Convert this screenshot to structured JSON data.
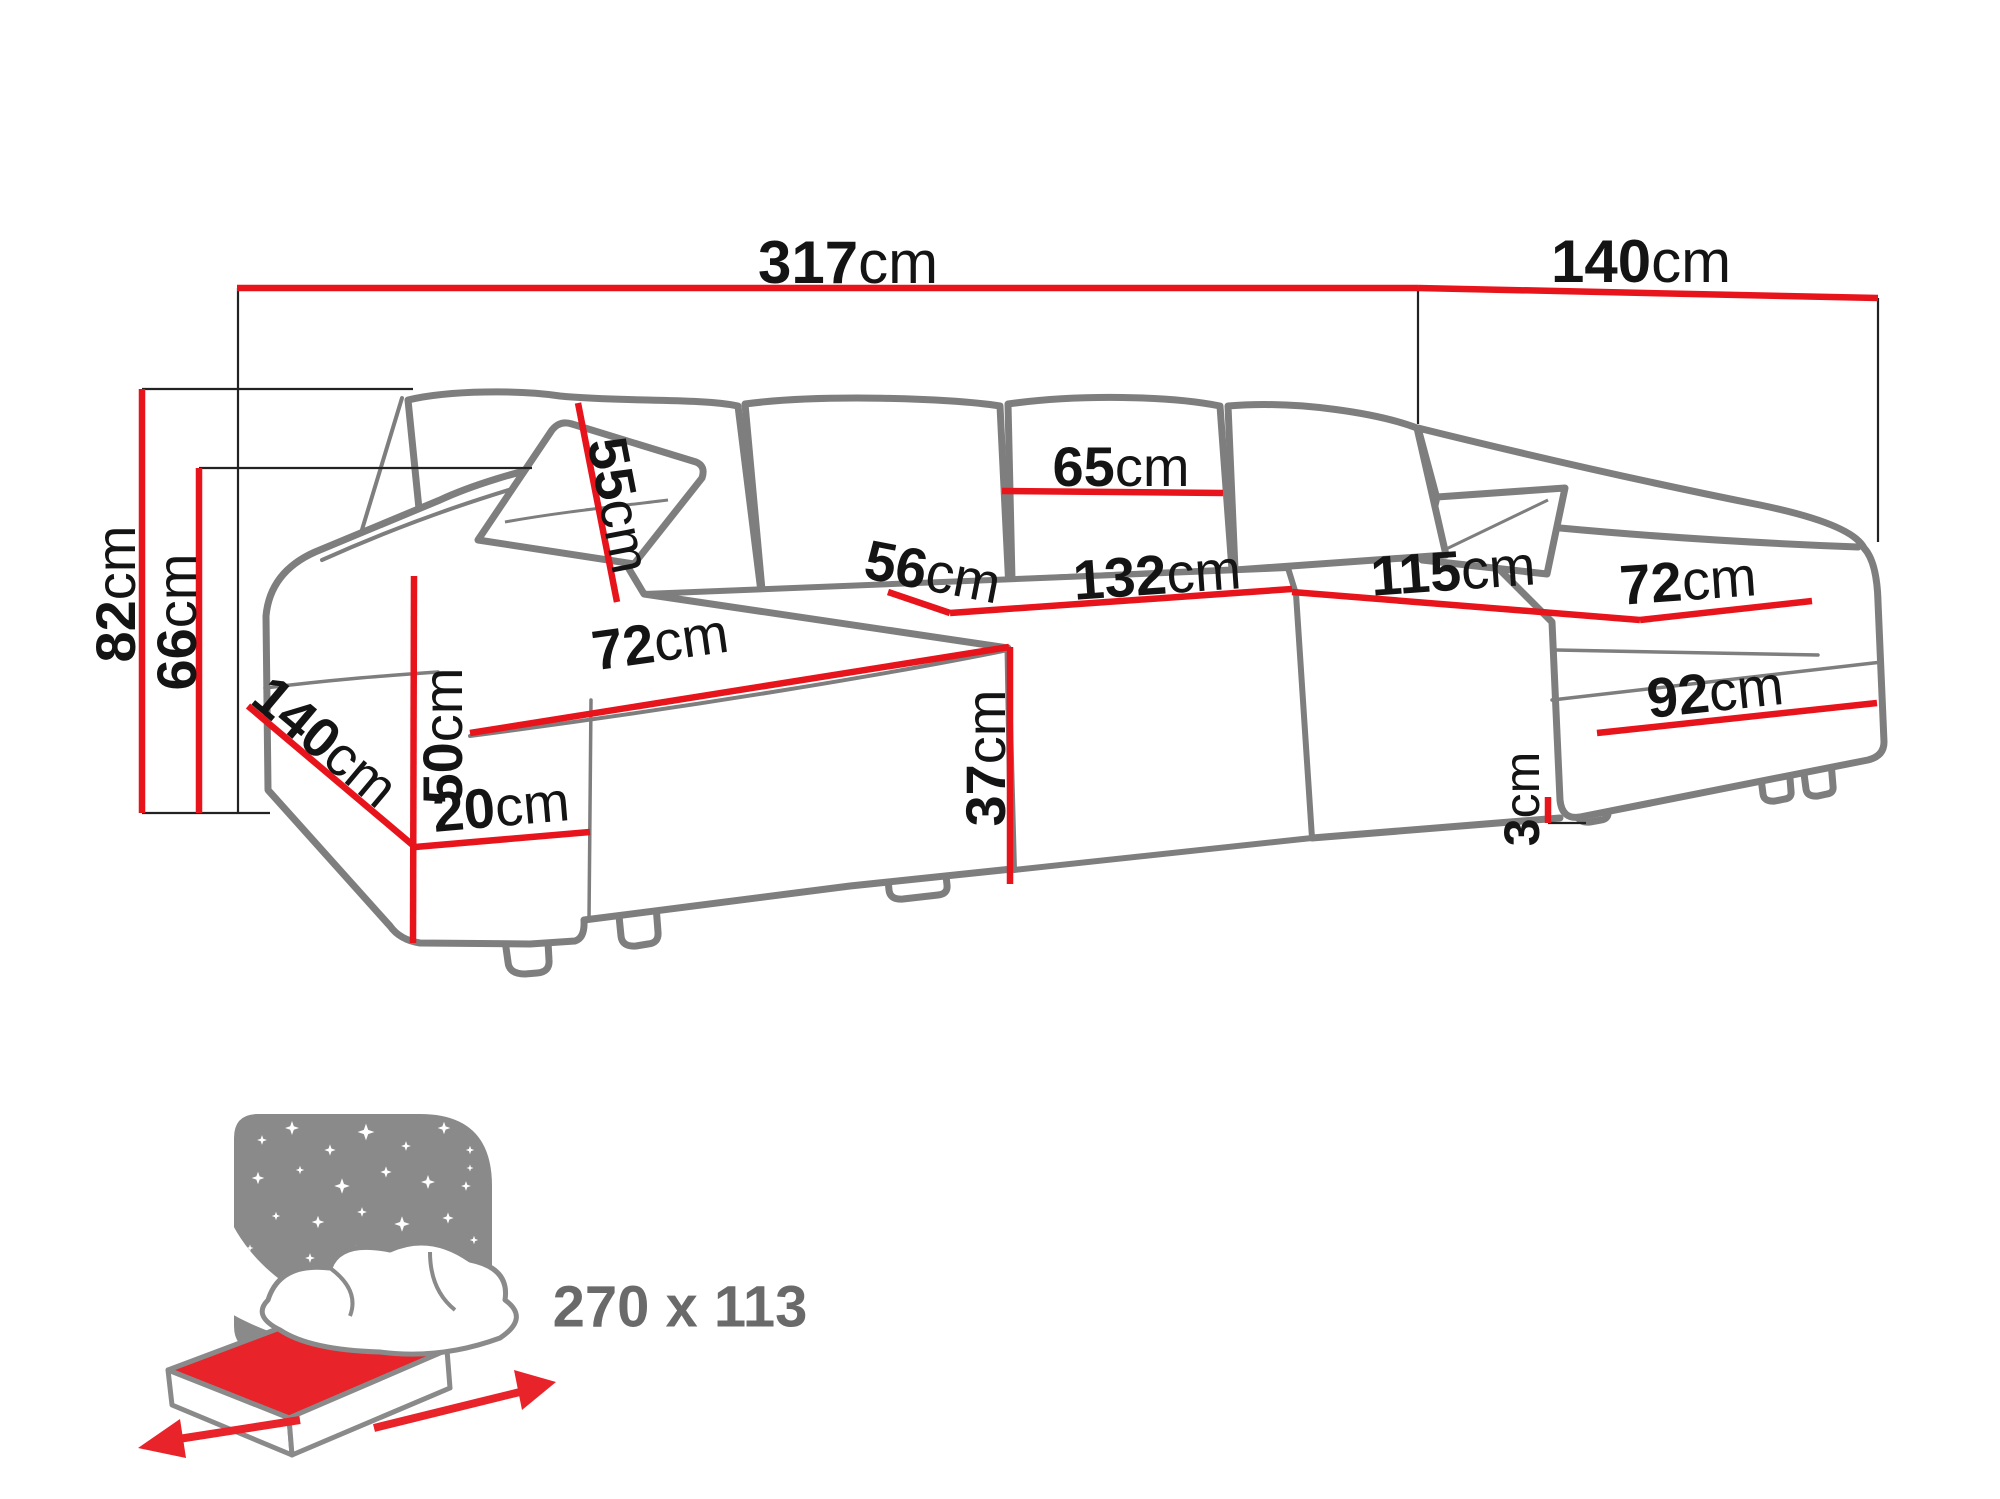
{
  "meta": {
    "description": "Dimension diagram of a U-shaped corner sofa bed with sleeping function",
    "unit": "cm"
  },
  "colors": {
    "dimension_line_red": "#e8141c",
    "sofa_outline_gray": "#7e7e7e",
    "label_black": "#141414",
    "icon_panel_gray": "#8a8a8a",
    "icon_text_gray": "#6a6a6a",
    "mattress_red": "#e8232a",
    "background": "#ffffff"
  },
  "labels": {
    "total_width": {
      "num": "317",
      "unit": "cm"
    },
    "right_depth": {
      "num": "140",
      "unit": "cm"
    },
    "total_height": {
      "num": "82",
      "unit": "cm"
    },
    "arm_height": {
      "num": "66",
      "unit": "cm"
    },
    "back_cushion_height": {
      "num": "55",
      "unit": "cm"
    },
    "back_cushion_width": {
      "num": "65",
      "unit": "cm"
    },
    "seat_depth": {
      "num": "56",
      "unit": "cm"
    },
    "middle_seat_width": {
      "num": "132",
      "unit": "cm"
    },
    "right_seat_length": {
      "num": "115",
      "unit": "cm"
    },
    "left_seat_width": {
      "num": "72",
      "unit": "cm"
    },
    "right_seat_width": {
      "num": "72",
      "unit": "cm"
    },
    "arm_front_height": {
      "num": "50",
      "unit": "cm"
    },
    "left_depth": {
      "num": "140",
      "unit": "cm"
    },
    "arm_bottom_width": {
      "num": "20",
      "unit": "cm"
    },
    "seat_height": {
      "num": "37",
      "unit": "cm"
    },
    "chaise_front_width": {
      "num": "92",
      "unit": "cm"
    },
    "leg_height": {
      "num": "3",
      "unit": "cm"
    }
  },
  "sleeping_area": {
    "label": "270 x 113",
    "width_cm": 270,
    "depth_cm": 113
  },
  "measurements_cm": {
    "total_width": 317,
    "right_section_depth": 140,
    "total_height": 82,
    "armrest_height": 66,
    "back_cushion_height": 55,
    "back_cushion_width": 65,
    "seat_depth": 56,
    "middle_seat_width": 132,
    "right_seat_length": 115,
    "left_seat_width": 72,
    "right_seat_width": 72,
    "armrest_front_height": 50,
    "left_section_depth": 140,
    "armrest_bottom_width": 20,
    "seat_height": 37,
    "right_chaise_front_width": 92,
    "leg_height": 3
  }
}
